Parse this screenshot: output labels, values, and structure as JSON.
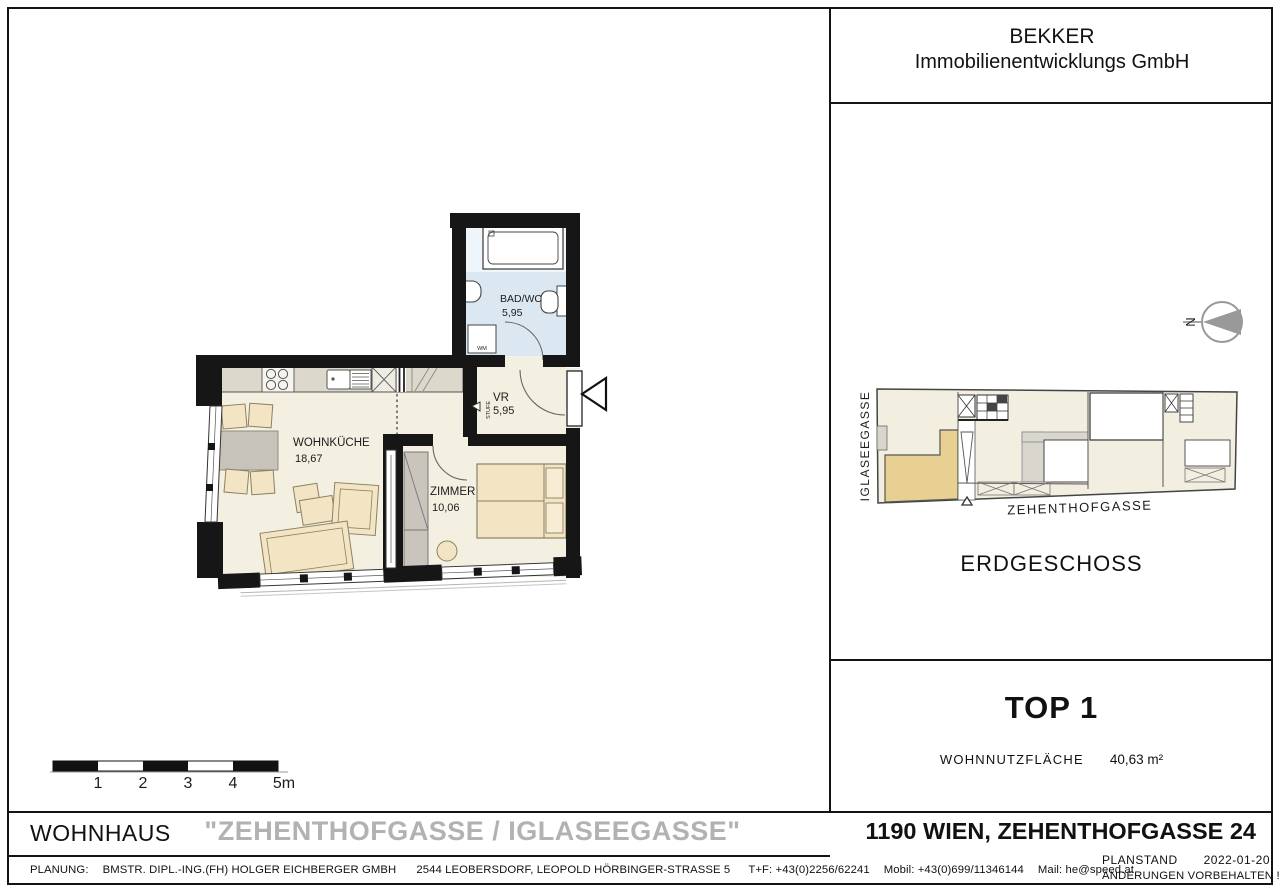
{
  "company": {
    "line1": "BEKKER",
    "line2": "Immobilienentwicklungs GmbH"
  },
  "plan": {
    "rooms": [
      {
        "name": "WOHNKÜCHE",
        "area": "18,67"
      },
      {
        "name": "ZIMMER",
        "area": "10,06"
      },
      {
        "name": "BAD/WC",
        "area": "5,95"
      },
      {
        "name": "VR",
        "area": "5,95"
      }
    ],
    "annotations": {
      "washer": "WM",
      "step": "STUFE"
    }
  },
  "scalebar": {
    "labels": [
      "1",
      "2",
      "3",
      "4",
      "5m"
    ]
  },
  "siteplan": {
    "street_left": "IGLASEEGASSE",
    "street_bottom": "ZEHENTHOFGASSE",
    "level": "ERDGESCHOSS",
    "north_letter": "N"
  },
  "unit": {
    "name": "TOP 1",
    "area_label": "WOHNNUTZFLÄCHE",
    "area_value": "40,63 m²"
  },
  "titleblock": {
    "building_type": "WOHNHAUS",
    "project": "\"ZEHENTHOFGASSE / IGLASEEGASSE\"",
    "address": "1190 WIEN, ZEHENTHOFGASSE 24"
  },
  "footer": {
    "label": "PLANUNG:",
    "firm": "BMSTR. DIPL.-ING.(FH) HOLGER EICHBERGER GMBH",
    "address": "2544 LEOBERSDORF, LEOPOLD HÖRBINGER-STRASSE 5",
    "phone": "T+F: +43(0)2256/62241",
    "mobile": "Mobil: +43(0)699/11346144",
    "email": "Mail: he@speed.at",
    "planstand_label": "PLANSTAND",
    "planstand_date": "2022-01-20",
    "note": "ÄNDERUNGEN VORBEHALTEN !"
  },
  "colors": {
    "wall": "#161616",
    "room": "#f4f0e1",
    "bath": "#dce8f1",
    "counter": "#dcd8cb",
    "furniture": "#f3e5c3",
    "gray_furniture": "#c9c5bc",
    "site_highlight": "#e8d092",
    "muted_title": "#b2b2b2"
  }
}
